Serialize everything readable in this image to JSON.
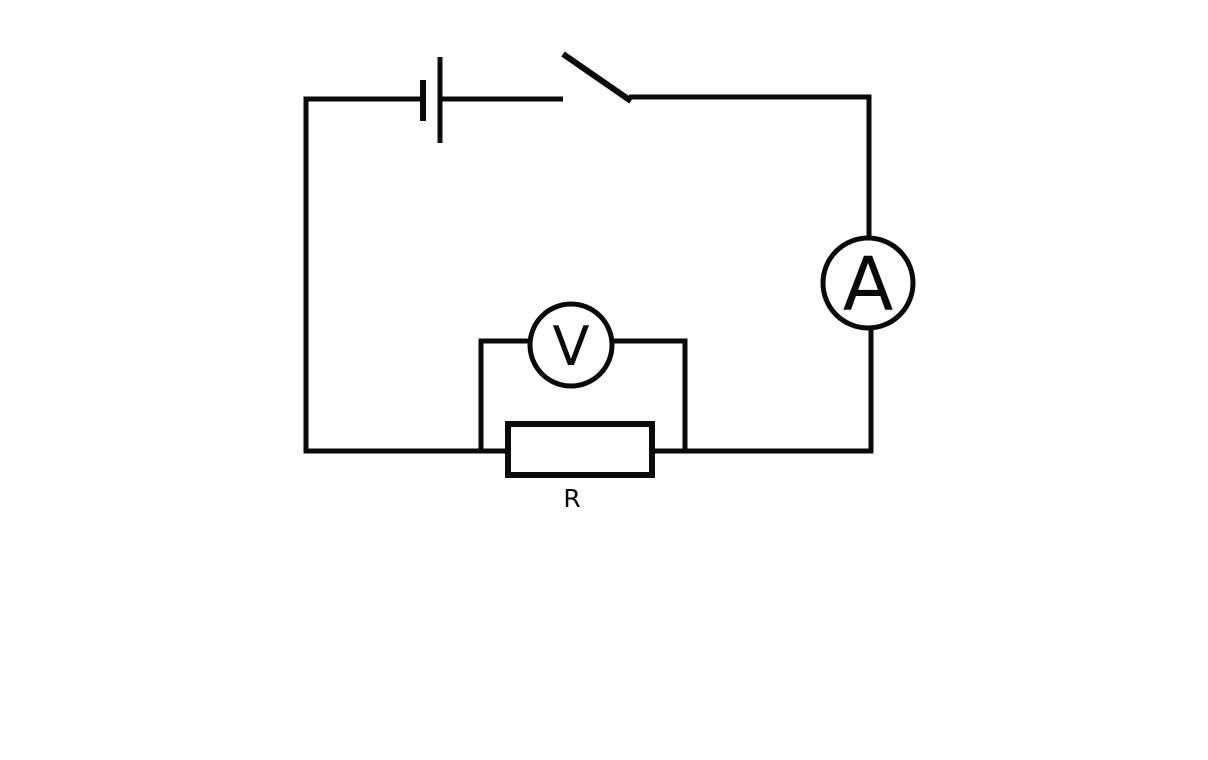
{
  "meta": {
    "background_color": "#ffffff",
    "ink_color": "#0a0a0a",
    "diagram_type": "series electric circuit with voltmeter in parallel across resistor"
  },
  "circuit": {
    "labels": {
      "ammeter": "A",
      "voltmeter": "V",
      "resistor": "R"
    },
    "components": [
      "battery-cell-icon",
      "open-switch-icon",
      "ammeter-icon",
      "voltmeter-icon",
      "resistor-icon"
    ]
  }
}
